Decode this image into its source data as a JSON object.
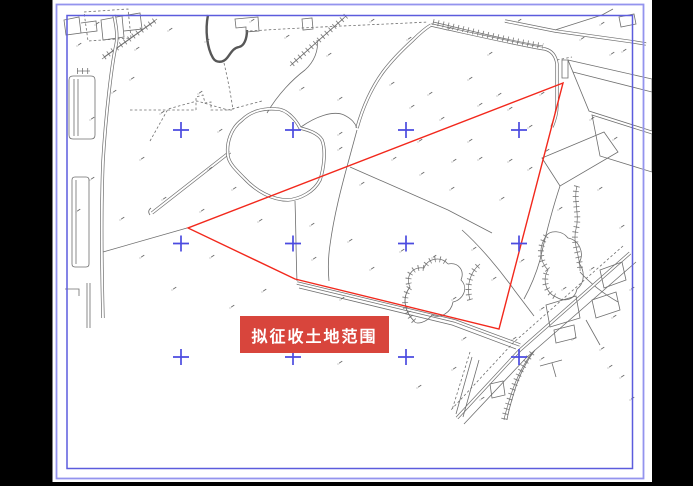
{
  "colors": {
    "page_bg": "#000000",
    "sheet_bg": "#ffffff",
    "map_line": "#6e6e6e",
    "map_line_dark": "#575757",
    "road_fill": "#ffffff",
    "border_outer": "#9494ee",
    "border_inner": "#5c5cdd",
    "cross": "#4b4be0",
    "red": "#f2281c",
    "label_bg": "#d8453c",
    "label_text": "#ffffff"
  },
  "label": {
    "text": "拟征收土地范围",
    "x": 240,
    "y": 316,
    "w": 149,
    "h": 37
  },
  "red_polygon": {
    "points": [
      [
        563,
        83
      ],
      [
        188,
        228
      ],
      [
        295,
        279
      ],
      [
        499,
        329
      ]
    ]
  },
  "crosses": {
    "xs": [
      181,
      293,
      406,
      519
    ],
    "ys": [
      130,
      243.5,
      357
    ],
    "arm": 8
  },
  "sheet": {
    "x": 52.5,
    "y": 0,
    "w": 599.5,
    "h": 482
  },
  "borders": {
    "outer": [
      56.5,
      4.5,
      587,
      474
    ],
    "inner": [
      67,
      15.5,
      565.5,
      453
    ]
  },
  "map": {
    "paths": [
      {
        "t": "t",
        "d": "M208,15 C205,30 207,48 213,58 C216,63 223,63 227,58 C231,53 233,48 239,47 C244,46 247,39 247,30"
      },
      {
        "t": "s",
        "d": "M235,19 L258,17 L259,31 L246,32 L246,27 L236,28 Z"
      },
      {
        "t": "s",
        "d": "M302,19 L312,18 L313,29 L303,30 Z"
      },
      {
        "t": "h",
        "d": "M104,57 L157,19"
      },
      {
        "t": "hl",
        "d": "M102,59 L155,21"
      },
      {
        "t": "h",
        "d": "M292,64 L346,16"
      },
      {
        "t": "hl",
        "d": "M290,66 L344,18"
      },
      {
        "t": "d",
        "d": "M250,31 C310,27 370,25 428,22"
      },
      {
        "t": "s",
        "d": "M267,113 C278,94 293,79 305,70 C314,62 319,50 317,40"
      },
      {
        "t": "d",
        "d": "M224,63 C228,80 231,96 233,110"
      },
      {
        "t": "d",
        "d": "M130,110 L196,110 M196,110 L196,97 L203,95 L205,103 L211,102 L211,110 L232,110"
      },
      {
        "t": "s",
        "d": "M64,20 L79,17 L81,33 L66,35 Z M81,23 L96,21 L97,31 L81,33"
      },
      {
        "t": "s",
        "d": "M101,20 L122,16 L124,37 L103,40 Z M122,16 L140,13 L142,29 L124,31"
      },
      {
        "t": "d",
        "d": "M84,12 L128,9 L131,38 L88,41 Z"
      },
      {
        "t": "s",
        "d": "M69,80 Q69,76 73,76 L91,76 Q95,76 95,80 L95,135 Q95,139 91,139 L73,139 Q69,139 69,135 Z M74,79 L74,136 M78,79 L78,136"
      },
      {
        "t": "h",
        "d": "M77,71 L90,71"
      },
      {
        "t": "b",
        "d": "M114,15 C116,25 118,36 116,45 C112,63 106,111 103,161 C101,210 102,280 103,318"
      },
      {
        "t": "s",
        "d": "M87,283 L87,328 M90,283 L90,328 M65,289 L79,289 L79,296"
      },
      {
        "t": "s",
        "d": "M72,180 Q72,177 75,177 L86,177 Q89,177 89,180 L89,264 Q89,267 86,267 L75,267 Q72,267 72,264 Z M76,180 L76,264"
      },
      {
        "t": "b",
        "d": "M152,213 L230,152"
      },
      {
        "t": "s",
        "d": "M150,215 q-3,-4 1,-7"
      },
      {
        "t": "s",
        "d": "M103,252 L187,228"
      },
      {
        "t": "b",
        "d": "M297,283 L455,321 L520,345"
      },
      {
        "t": "s",
        "d": "M299,288 L452,325 L516,349"
      },
      {
        "t": "b",
        "d": "M228,156 C226,143 231,128 242,120 C250,112 262,108 276,109 C288,109 297,122 300,128 C308,130 318,133 322,140 C326,150 324,168 320,180 C314,192 300,199 288,200 C272,200 256,191 244,178 C235,169 229,163 228,156 Z"
      },
      {
        "t": "s",
        "d": "M295,201 C296,230 296,258 297,281"
      },
      {
        "t": "s",
        "d": "M348,163 C342,185 334,215 330,245 C328,258 328,270 329,281"
      },
      {
        "t": "s",
        "d": "M348,163 L357,130"
      },
      {
        "t": "s",
        "d": "M350,167 L448,210 L492,233"
      },
      {
        "t": "b",
        "d": "M357,128 C362,110 370,90 383,72 C392,60 402,50 413,40 C420,33 426,28 431,25"
      },
      {
        "t": "b",
        "d": "M431,25 C468,33 515,44 545,49 C553,51 556,57 557,64 L557,105 C557,113 555,120 552,127"
      },
      {
        "t": "h",
        "d": "M433,22 C468,30 510,41 543,46"
      },
      {
        "t": "d",
        "d": "M557,60 L572,57"
      },
      {
        "t": "s",
        "d": "M562,60 L568,60 L568,78 L562,78 Z"
      },
      {
        "t": "s",
        "d": "M568,60 L652,79 L652,131 L589,111 Z M573,72 L652,92"
      },
      {
        "t": "s",
        "d": "M592,115 L652,134 L652,172 L600,156 Z"
      },
      {
        "t": "s",
        "d": "M619,17 L634,14 L636,24 L621,27 Z"
      },
      {
        "t": "b",
        "d": "M505,21 L555,31 L634,42 L646,44"
      },
      {
        "t": "s",
        "d": "M555,30 L602,15 L613,9"
      },
      {
        "t": "s",
        "d": "M542,158 L604,132 L618,152 L560,186 Z"
      },
      {
        "t": "h",
        "d": "M577,186 C573,200 580,214 576,229 C572,244 581,258 580,271"
      },
      {
        "t": "s",
        "d": "M560,186 C552,210 545,238 540,260 C536,274 530,288 524,299"
      },
      {
        "t": "s",
        "d": "M580,272 C590,283 604,294 618,302"
      },
      {
        "t": "b",
        "d": "M630,253 L520,350 L457,418"
      },
      {
        "t": "s",
        "d": "M636,262 L526,358 L464,424"
      },
      {
        "t": "d",
        "d": "M623,246 L513,343 L450,411"
      },
      {
        "t": "h",
        "d": "M532,353 C522,366 515,381 510,398 C507,408 505,414 504,420"
      },
      {
        "t": "s",
        "d": "M535,350 C525,363 518,378 513,396 C510,406 508,413 507,420"
      },
      {
        "t": "s",
        "d": "M490,384 L503,381 L505,395 L492,398 Z M546,305 L576,296 L580,318 L550,327 Z M554,330 L574,325 L576,338 L556,343 Z M592,300 L616,292 L620,310 L596,318 Z M600,270 L622,262 L626,280 L604,288 Z"
      },
      {
        "t": "s",
        "d": "M586,320 L600,345 M540,366 L562,360 M552,363 L556,377"
      },
      {
        "t": "h",
        "d": "M414,321 C404,311 402,297 410,287 C405,277 412,266 424,268 C428,258 441,256 448,264"
      },
      {
        "t": "s",
        "d": "M448,264 C458,262 465,270 461,280 C469,288 463,300 453,302 C451,313 440,319 432,315 C426,323 416,325 414,321 C404,311 402,297 410,287"
      },
      {
        "t": "h",
        "d": "M470,300 C466,286 470,272 480,264"
      },
      {
        "t": "h",
        "d": "M546,236 C538,248 540,262 548,270 C542,280 546,293 556,297"
      },
      {
        "t": "s",
        "d": "M556,297 C566,303 575,299 577,289 C585,283 585,271 579,263 C585,253 579,240 568,238 C562,230 550,230 546,236"
      },
      {
        "t": "s",
        "d": "M462,230 C480,246 500,270 515,291 C521,299 528,308 534,316"
      },
      {
        "t": "d",
        "d": "M150,141 L168,109 L197,101 L228,110 L262,101"
      },
      {
        "t": "s",
        "d": "M301,127 C315,117 333,110 344,115 C352,119 355,123 357,128"
      },
      {
        "t": "d",
        "d": "M470,352 L452,410"
      },
      {
        "t": "s",
        "d": "M479,360 L463,417 M472,357 L456,414"
      }
    ],
    "marks": [
      [
        95,
        25
      ],
      [
        135,
        50
      ],
      [
        168,
        31
      ],
      [
        205,
        42
      ],
      [
        250,
        22
      ],
      [
        285,
        38
      ],
      [
        327,
        56
      ],
      [
        370,
        22
      ],
      [
        407,
        40
      ],
      [
        447,
        30
      ],
      [
        488,
        55
      ],
      [
        517,
        22
      ],
      [
        600,
        25
      ],
      [
        622,
        52
      ],
      [
        580,
        40
      ],
      [
        610,
        55
      ],
      [
        77,
        46
      ],
      [
        130,
        80
      ],
      [
        160,
        114
      ],
      [
        198,
        94
      ],
      [
        300,
        90
      ],
      [
        338,
        100
      ],
      [
        390,
        85
      ],
      [
        428,
        95
      ],
      [
        468,
        80
      ],
      [
        508,
        110
      ],
      [
        540,
        95
      ],
      [
        590,
        120
      ],
      [
        613,
        140
      ],
      [
        90,
        120
      ],
      [
        112,
        93
      ],
      [
        140,
        160
      ],
      [
        162,
        200
      ],
      [
        208,
        170
      ],
      [
        218,
        132
      ],
      [
        338,
        135
      ],
      [
        338,
        150
      ],
      [
        360,
        185
      ],
      [
        392,
        160
      ],
      [
        420,
        175
      ],
      [
        450,
        190
      ],
      [
        478,
        160
      ],
      [
        500,
        200
      ],
      [
        528,
        170
      ],
      [
        558,
        210
      ],
      [
        598,
        190
      ],
      [
        620,
        228
      ],
      [
        90,
        180
      ],
      [
        76,
        212
      ],
      [
        120,
        220
      ],
      [
        200,
        212
      ],
      [
        232,
        190
      ],
      [
        258,
        222
      ],
      [
        310,
        226
      ],
      [
        348,
        242
      ],
      [
        440,
        120
      ],
      [
        468,
        142
      ],
      [
        497,
        96
      ],
      [
        528,
        128
      ],
      [
        478,
        106
      ],
      [
        418,
        142
      ],
      [
        452,
        162
      ],
      [
        508,
        162
      ],
      [
        545,
        152
      ],
      [
        410,
        108
      ],
      [
        140,
        258
      ],
      [
        172,
        290
      ],
      [
        210,
        258
      ],
      [
        230,
        308
      ],
      [
        262,
        292
      ],
      [
        312,
        260
      ],
      [
        340,
        300
      ],
      [
        370,
        270
      ],
      [
        400,
        252
      ],
      [
        432,
        258
      ],
      [
        452,
        300
      ],
      [
        472,
        250
      ],
      [
        492,
        280
      ],
      [
        520,
        262
      ],
      [
        540,
        310
      ],
      [
        562,
        290
      ],
      [
        590,
        270
      ],
      [
        612,
        318
      ],
      [
        630,
        290
      ],
      [
        338,
        364
      ],
      [
        417,
        388
      ],
      [
        452,
        370
      ],
      [
        480,
        400
      ],
      [
        512,
        340
      ],
      [
        540,
        360
      ],
      [
        572,
        340
      ],
      [
        600,
        350
      ],
      [
        620,
        378
      ],
      [
        462,
        340
      ],
      [
        608,
        368
      ],
      [
        630,
        400
      ]
    ]
  }
}
